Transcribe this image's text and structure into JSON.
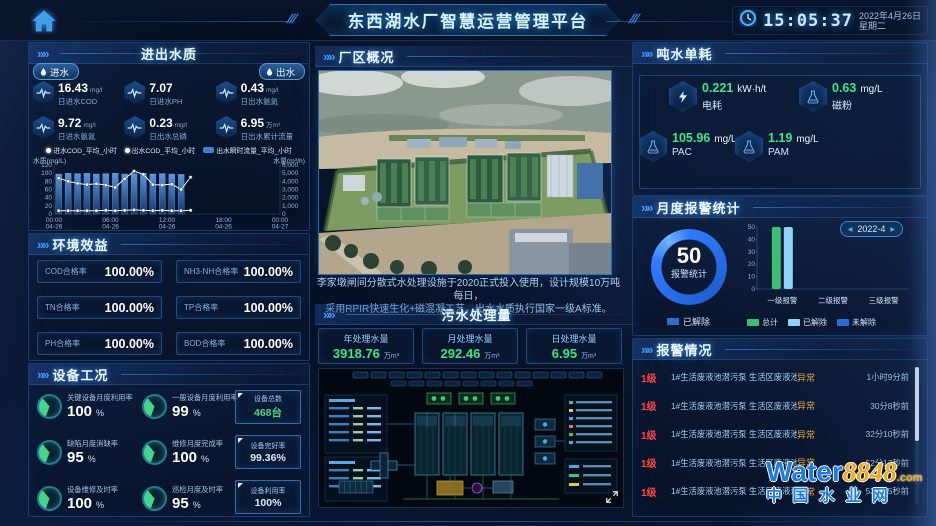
{
  "header": {
    "title": "东西湖水厂智慧运营管理平台",
    "time": "15:05:37",
    "date": "2022年4月26日",
    "weekday": "星期二"
  },
  "water_quality": {
    "title": "进出水质",
    "inlet_label": "进水",
    "outlet_label": "出水",
    "metrics": [
      {
        "value": "16.43",
        "unit": "mg/l",
        "label": "日进水COD"
      },
      {
        "value": "7.07",
        "unit": "",
        "label": "日进水PH"
      },
      {
        "value": "0.43",
        "unit": "mg/l",
        "label": "日出水氨氮"
      },
      {
        "value": "9.72",
        "unit": "mg/l",
        "label": "日进水氨氮"
      },
      {
        "value": "0.23",
        "unit": "mg/l",
        "label": "日出水总磷"
      },
      {
        "value": "6.95",
        "unit": "万m³",
        "label": "日出水累计流量"
      }
    ],
    "chart_data": {
      "type": "line+bar",
      "legend": [
        {
          "name": "进水COD_平均_小时",
          "marker": "line-dot"
        },
        {
          "name": "出水COD_平均_小时",
          "marker": "line-dot"
        },
        {
          "name": "出水瞬时流量_平均_小时",
          "marker": "bar"
        }
      ],
      "left_axis": {
        "label": "水质(mg/L)",
        "min": 0,
        "max": 120,
        "step": 20
      },
      "right_axis": {
        "label": "水量(m³/h)",
        "min": 0,
        "max": 6000,
        "step": 1000
      },
      "x_hours_span": 24,
      "x_ticks": [
        {
          "t": "00:00",
          "d": "04-26",
          "h": 0
        },
        {
          "t": "06:00",
          "d": "04-26",
          "h": 6
        },
        {
          "t": "12:00",
          "d": "04-26",
          "h": 12
        },
        {
          "t": "18:00",
          "d": "04-26",
          "h": 18
        },
        {
          "t": "00:00",
          "d": "04-27",
          "h": 24
        }
      ],
      "series": [
        {
          "name": "进水COD_平均_小时",
          "type": "line",
          "axis": "left",
          "color": "#f2f8ff",
          "values": [
            88,
            80,
            75,
            72,
            74,
            71,
            65,
            86,
            105,
            97,
            72,
            71,
            73,
            60,
            90
          ]
        },
        {
          "name": "出水COD_平均_小时",
          "type": "line",
          "axis": "left",
          "color": "#ffffff",
          "values": [
            8,
            8,
            8,
            8,
            8,
            9,
            8,
            9,
            10,
            9,
            8,
            9,
            8,
            8,
            9
          ]
        },
        {
          "name": "出水瞬时流量_平均_小时",
          "type": "bar",
          "axis": "right",
          "color": "#2d62b8",
          "values": [
            4900,
            5000,
            4950,
            5000,
            4900,
            4950,
            5000,
            4900,
            4950,
            5000,
            4900,
            4950,
            4900,
            4850
          ]
        }
      ]
    }
  },
  "env": {
    "title": "环境效益",
    "items": [
      {
        "label": "COD合格率",
        "value": "100.00%"
      },
      {
        "label": "NH3-NH合格率",
        "value": "100.00%"
      },
      {
        "label": "TN合格率",
        "value": "100.00%"
      },
      {
        "label": "TP合格率",
        "value": "100.00%"
      },
      {
        "label": "PH合格率",
        "value": "100.00%"
      },
      {
        "label": "BOD合格率",
        "value": "100.00%"
      }
    ]
  },
  "equipment": {
    "title": "设备工况",
    "percent": "%",
    "gauges": [
      {
        "label": "关键设备月度利用率",
        "value": "100"
      },
      {
        "label": "一般设备月度利用率",
        "value": "99"
      },
      {
        "label": "缺陷月度消缺率",
        "value": "95"
      },
      {
        "label": "维修月度完成率",
        "value": "100"
      },
      {
        "label": "设备维修及时率",
        "value": "100"
      },
      {
        "label": "巡检月度及时率",
        "value": "95"
      }
    ],
    "stats": [
      {
        "label": "设备总数",
        "value": "468台"
      },
      {
        "label": "设备完好率",
        "value": "99.36%"
      },
      {
        "label": "设备利用率",
        "value": "100%"
      }
    ]
  },
  "plant": {
    "title": "厂区概况",
    "desc_line1": "李家墩闸间分散式水处理设施于2020正式投入使用，设计规模10万吨每日，",
    "desc_line2": "采用RPIR快速生化+磁混凝工艺，出水水质执行国家一级A标准。"
  },
  "sewage": {
    "title": "污水处理量",
    "stats": [
      {
        "label": "年处理水量",
        "value": "3918.76",
        "unit": "万m³"
      },
      {
        "label": "月处理水量",
        "value": "292.46",
        "unit": "万m³"
      },
      {
        "label": "日处理水量",
        "value": "6.95",
        "unit": "万m³"
      }
    ]
  },
  "consumption": {
    "title": "吨水单耗",
    "items": [
      {
        "label": "电耗",
        "value": "0.221",
        "unit": "kW·h/t",
        "icon": "lightning"
      },
      {
        "label": "磁粉",
        "value": "0.63",
        "unit": "mg/L",
        "icon": "flask"
      },
      {
        "label": "PAC",
        "value": "105.96",
        "unit": "mg/L",
        "icon": "flask"
      },
      {
        "label": "PAM",
        "value": "1.19",
        "unit": "mg/L",
        "icon": "flask"
      }
    ]
  },
  "alarm_stats": {
    "title": "月度报警统计",
    "month": "2022-4",
    "donut_value": "50",
    "donut_label": "报警统计",
    "donut_legend": "已解除",
    "chart_data": {
      "type": "bar",
      "categories": [
        "一级报警",
        "二级报警",
        "三级报警"
      ],
      "ylim": [
        0,
        50
      ],
      "ystep": 10,
      "series": [
        {
          "name": "总计",
          "color": "#3dbd72",
          "values": [
            50,
            0,
            0
          ]
        },
        {
          "name": "已解除",
          "color": "#8fd4f5",
          "values": [
            50,
            0,
            0
          ]
        },
        {
          "name": "未解除",
          "color": "#2a6fd0",
          "values": [
            0,
            0,
            0
          ]
        }
      ]
    }
  },
  "alarms": {
    "title": "报警情况",
    "rows": [
      {
        "level": "1级",
        "desc": "1#生活废液池潜污泵 生活区废液池",
        "status": "异常",
        "time": "1小时9分前"
      },
      {
        "level": "1级",
        "desc": "1#生活废液池潜污泵 生活区废液池",
        "status": "异常",
        "time": "30分8秒前"
      },
      {
        "level": "1级",
        "desc": "1#生活废液池潜污泵 生活区废液池",
        "status": "异常",
        "time": "32分10秒前"
      },
      {
        "level": "1级",
        "desc": "1#生活废液池潜污泵 生活区废液池",
        "status": "异常",
        "time": "52分17秒前"
      },
      {
        "level": "1级",
        "desc": "1#生活废液池潜污泵 生活区废液池",
        "status": "异常",
        "time": "53分25秒前"
      }
    ]
  },
  "watermark": {
    "word": "Water",
    "num": "8848",
    "dot": ".com",
    "cn": "中 国 水 业 网"
  }
}
